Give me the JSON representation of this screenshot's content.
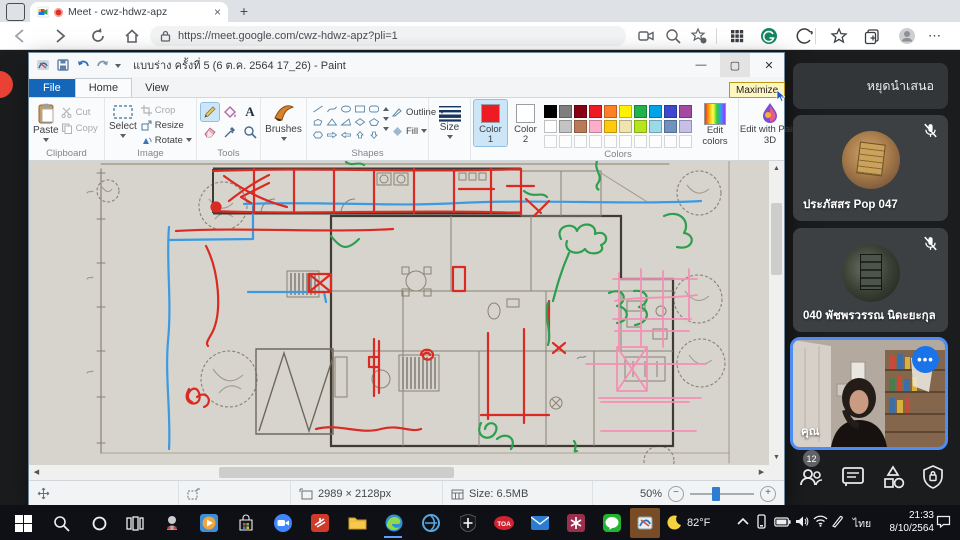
{
  "browser": {
    "tab_title": "Meet - cwz-hdwz-apz",
    "close_tab": "×",
    "new_tab": "+",
    "url": "https://meet.google.com/cwz-hdwz-apz?pli=1",
    "more": "⋯"
  },
  "paint": {
    "window_title": "แบบร่าง ครั้งที่ 5 (6 ต.ค. 2564 17_26) - Paint",
    "maximize_tooltip": "Maximize",
    "tabs": {
      "file": "File",
      "home": "Home",
      "view": "View"
    },
    "clipboard": {
      "label": "Clipboard",
      "paste": "Paste",
      "cut": "Cut",
      "copy": "Copy"
    },
    "image": {
      "label": "Image",
      "select": "Select",
      "crop": "Crop",
      "resize": "Resize",
      "rotate": "Rotate"
    },
    "tools_label": "Tools",
    "brushes": "Brushes",
    "shapes": {
      "label": "Shapes",
      "outline": "Outline",
      "fill": "Fill"
    },
    "size": "Size",
    "colors": {
      "label": "Colors",
      "color1": "Color 1",
      "color2": "Color 2",
      "color1_value": "#ed1c24",
      "color2_value": "#ffffff",
      "row1": [
        "#000000",
        "#7f7f7f",
        "#880015",
        "#ed1c24",
        "#ff7f27",
        "#fff200",
        "#22b14c",
        "#00a2e8",
        "#3f48cc",
        "#a349a4"
      ],
      "row2": [
        "#ffffff",
        "#c3c3c3",
        "#b97a57",
        "#ffaec9",
        "#ffc90e",
        "#efe4b0",
        "#b5e61d",
        "#99d9ea",
        "#7092be",
        "#c8bfe7"
      ],
      "edit_colors": "Edit colors",
      "edit_paint3d": "Edit with Paint 3D"
    },
    "status": {
      "dimensions": "2989 × 2128px",
      "file_size": "Size: 6.5MB",
      "zoom_level": "50%"
    }
  },
  "meet": {
    "stop_presenting": "หยุดนำเสนอ",
    "participants": [
      {
        "name": "ประภัสสร Pop 047"
      },
      {
        "name": "040 พัชพรวรรณ นิดะยะกุล"
      }
    ],
    "self_label": "คุณ",
    "people_count": "12",
    "accent_blue": "#4e8cf7"
  },
  "taskbar": {
    "temperature": "82°F",
    "language": "ไทย",
    "time": "21:33",
    "date": "8/10/2564"
  }
}
